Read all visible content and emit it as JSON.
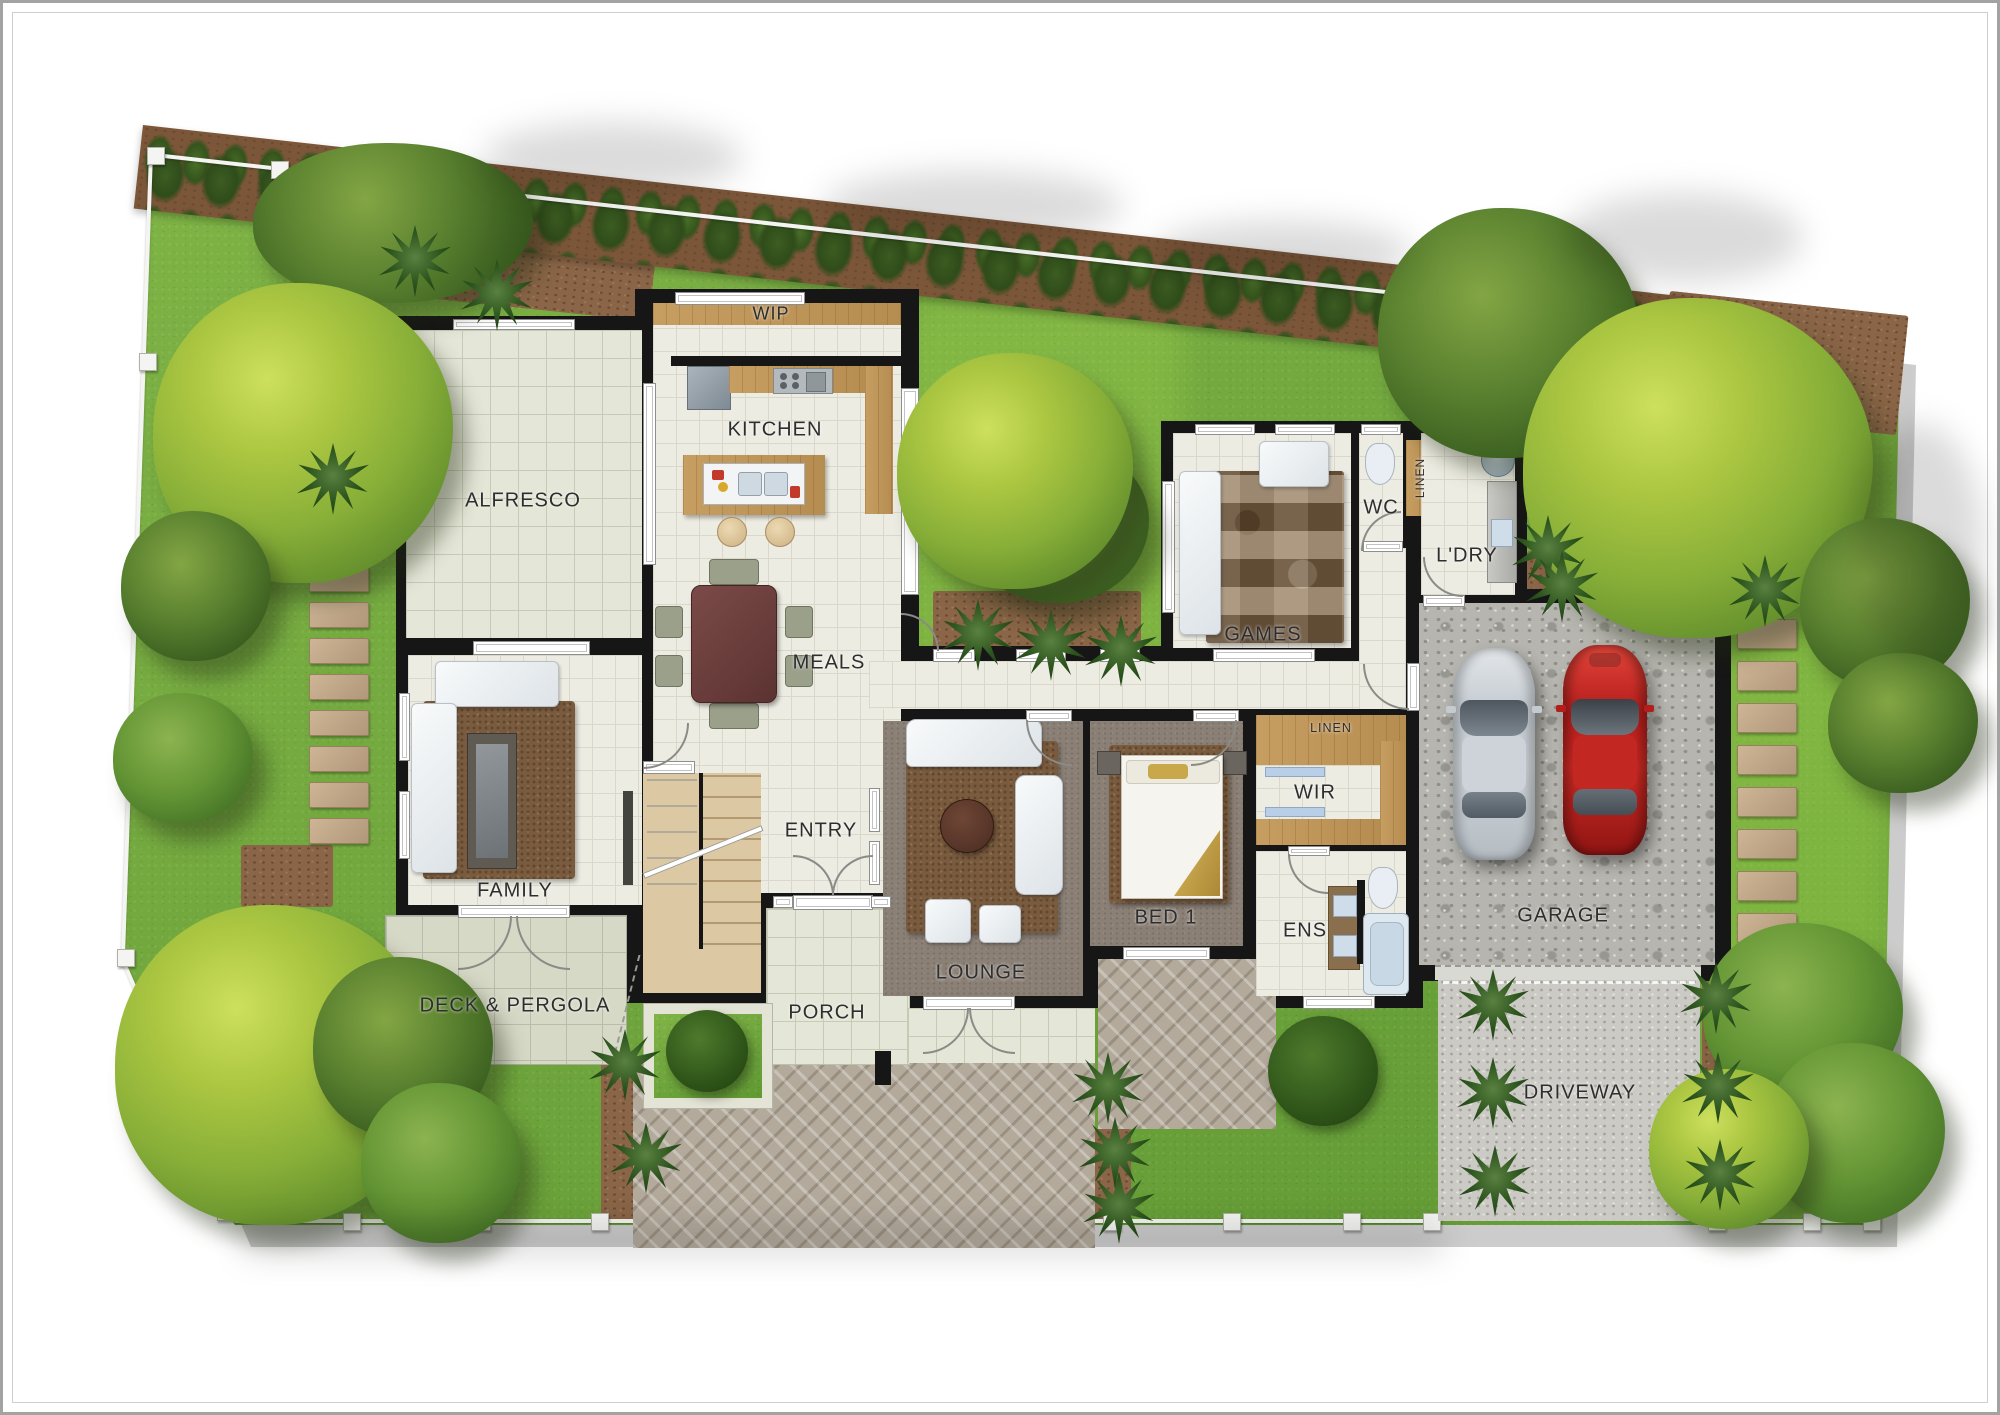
{
  "labels": {
    "alfresco": "ALFRESCO",
    "wip": "WIP",
    "kitchen": "KITCHEN",
    "meals": "MEALS",
    "family": "FAMILY",
    "entry": "ENTRY",
    "deck_pergola": "DECK & PERGOLA",
    "porch": "PORCH",
    "lounge": "LOUNGE",
    "bed1": "BED 1",
    "games": "GAMES",
    "wc": "WC",
    "linen_hall": "LINEN",
    "ldry": "L'DRY",
    "wir": "WIR",
    "linen_wir": "LINEN",
    "ens": "ENS",
    "garage": "GARAGE",
    "driveway": "DRIVEWAY"
  },
  "colors": {
    "grass": "#71ab3c",
    "mulch": "#8a6547",
    "wall": "#161616",
    "tile": "#edece3",
    "timber": "#c79e62",
    "carpet": "#8b8076",
    "deck": "#d7d9c7",
    "concrete": "#b6b5af",
    "hedge_green": "#33511f",
    "canopy_bright": "#a9c43f",
    "canopy_dark": "#4c7329",
    "car_red": "#c3201f",
    "car_silver": "#c7ced4",
    "fence": "#f4f4f2",
    "label_text": "#2e2e2e"
  }
}
